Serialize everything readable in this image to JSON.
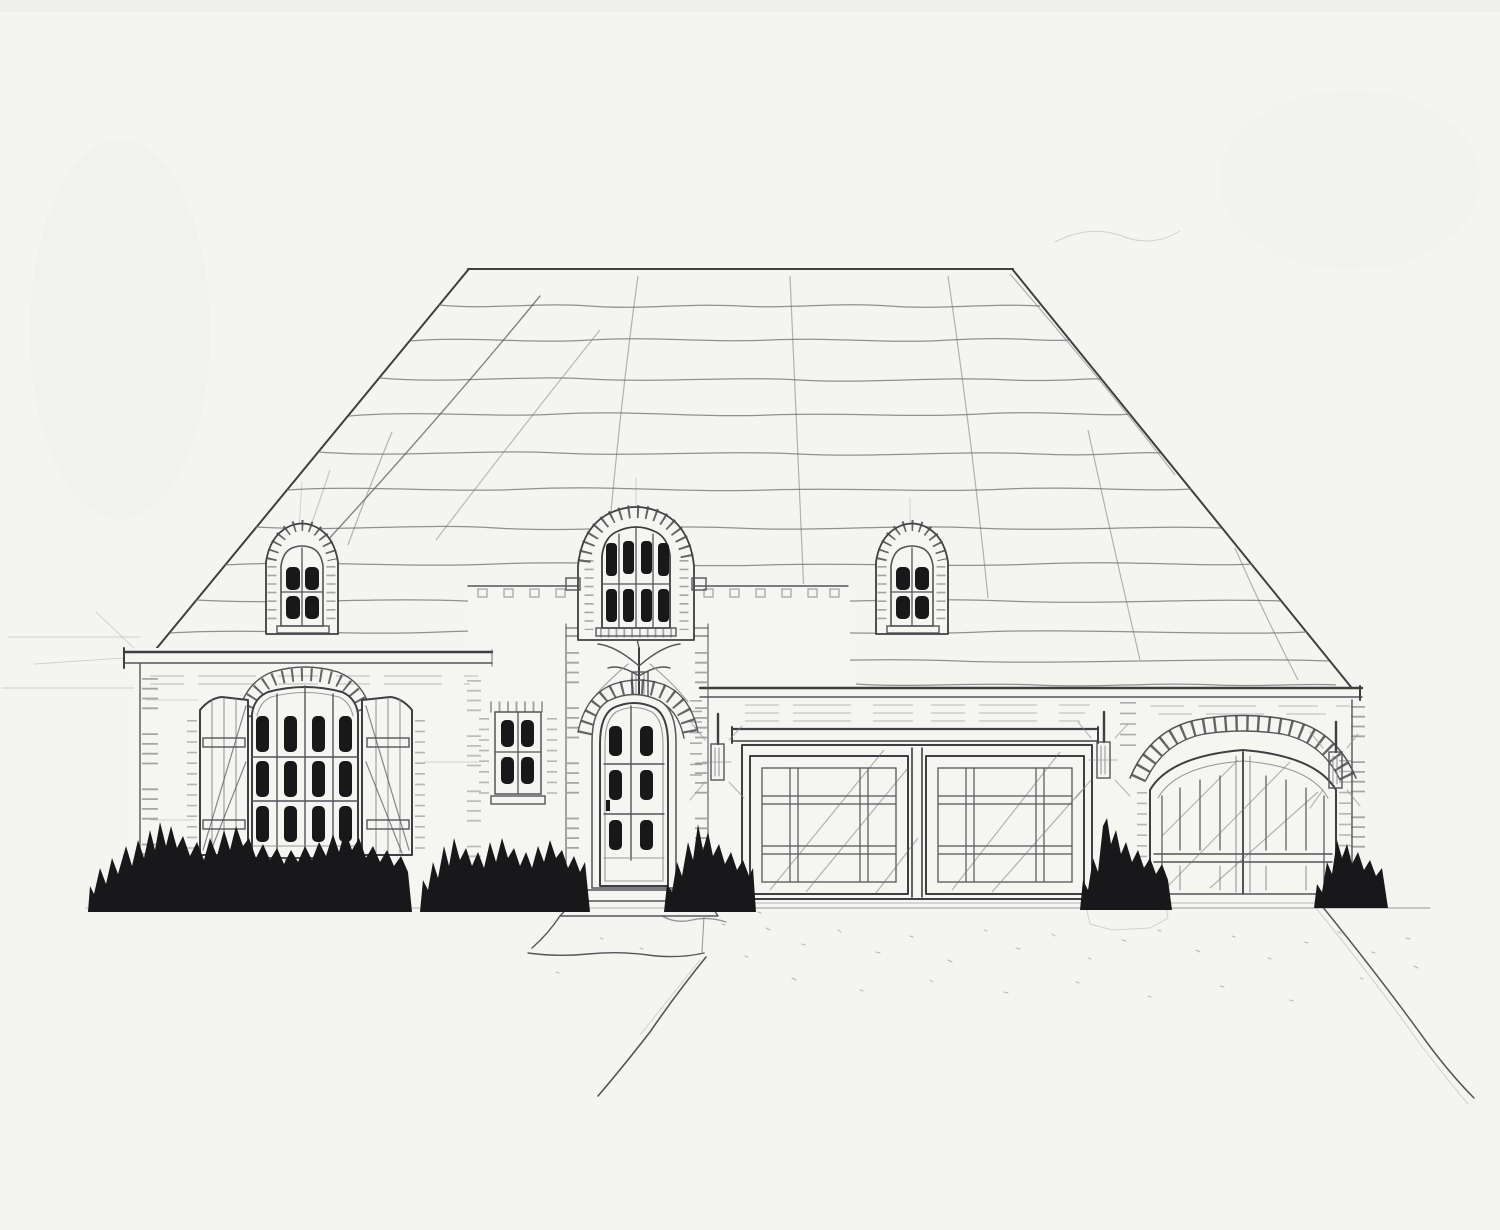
{
  "artwork": {
    "title": "Hand-drawn pencil front elevation sketch of a French country style house",
    "medium": "graphite pencil and ink on white paper",
    "scene": {
      "roof": "large hipped roof with hand-sketched horizontal shingle course lines",
      "dormers": [
        "left arched dormer with 4-pane window",
        "center arched wall dormer with 8-pane window over the entry",
        "right arched dormer with 4-pane window"
      ],
      "left_wing": "tall arched 12-pane window with brick arch header and paneled shutters",
      "entry": "arched brick entry surround with iron finial ornament and glazed 6-lite front door with stoop steps",
      "garage_doors": [
        "double craftsman-grid garage door",
        "arched double carriage-style garage door with brick voussoir header"
      ],
      "wall_sconces": 3,
      "landscape": "black inked shrub silhouettes along the foundation, flared front walk, speckled driveway with curved right edge"
    }
  },
  "palette": {
    "paper": "#f4f4f1",
    "pencil_light": "#8a8a8e",
    "pencil_mid": "#55555a",
    "pencil_dark": "#3f3f43",
    "ink_fill": "#18181a"
  }
}
